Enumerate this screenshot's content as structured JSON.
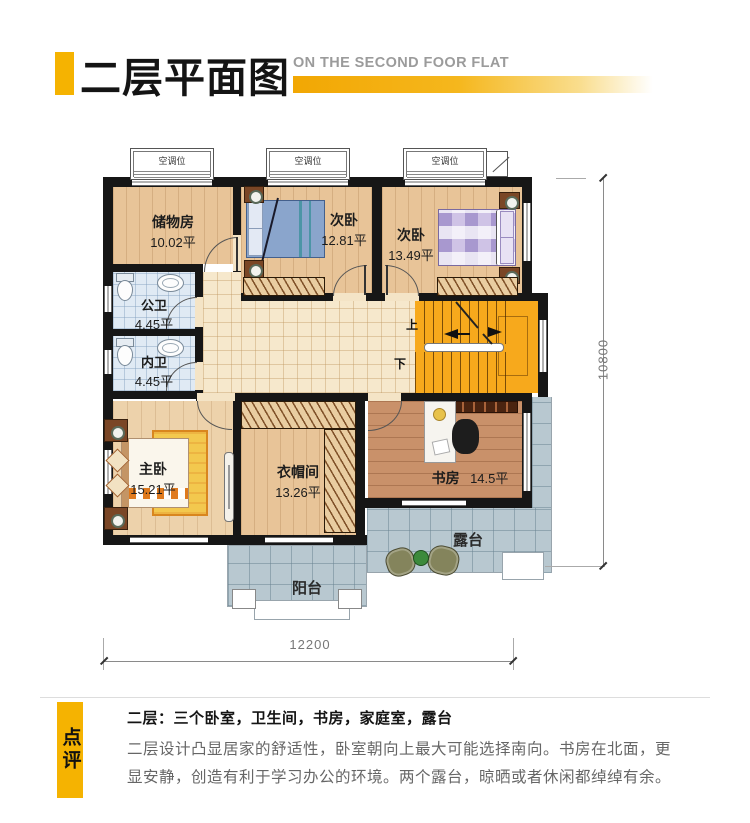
{
  "colors": {
    "accent_yellow": "#f5b301",
    "wall_black": "#161616",
    "stairs_orange": "#f7a91c"
  },
  "header": {
    "title_cn": "二层平面图",
    "title_en": "ON THE SECOND FOOR FLAT"
  },
  "plan": {
    "ac_label": "空调位",
    "stairs": {
      "up": "上",
      "down": "下"
    },
    "rooms": [
      {
        "id": "storage",
        "name": "储物房",
        "area": "10.02平"
      },
      {
        "id": "bedroom-2a",
        "name": "次卧",
        "area": "12.81平"
      },
      {
        "id": "bedroom-2b",
        "name": "次卧",
        "area": "13.49平"
      },
      {
        "id": "bath-public",
        "name": "公卫",
        "area": "4.45平"
      },
      {
        "id": "bath-inner",
        "name": "内卫",
        "area": "4.45平"
      },
      {
        "id": "master-bedroom",
        "name": "主卧",
        "area": "15.21平"
      },
      {
        "id": "cloakroom",
        "name": "衣帽间",
        "area": "13.26平"
      },
      {
        "id": "study",
        "name": "书房",
        "area": "14.5平"
      },
      {
        "id": "terrace",
        "name": "露台"
      },
      {
        "id": "balcony",
        "name": "阳台"
      }
    ],
    "dimensions": {
      "width": "12200",
      "height": "10800"
    }
  },
  "review": {
    "tag": "点评",
    "title": "二层：三个卧室，卫生间，书房，家庭室，露台",
    "body_line1": "二层设计凸显居家的舒适性，卧室朝向上最大可能选择南向。书房在北面，更",
    "body_line2": "显安静，创造有利于学习办公的环境。两个露台，晾晒或者休闲都绰绰有余。"
  }
}
